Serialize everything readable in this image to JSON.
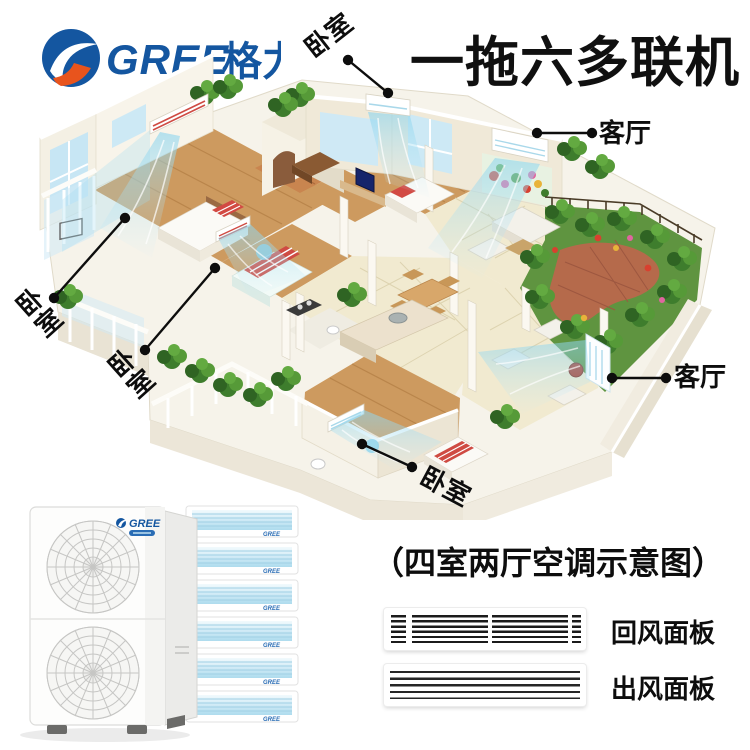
{
  "header": {
    "logo": {
      "text_en": "GREE",
      "text_cn": "格力"
    },
    "title": "一拖六多联机"
  },
  "diagram": {
    "callouts": [
      {
        "id": "bedroom-top",
        "label": "卧室"
      },
      {
        "id": "living-top-right",
        "label": "客厅"
      },
      {
        "id": "bedroom-left",
        "label": "卧室"
      },
      {
        "id": "bedroom-mid-left",
        "label": "卧室"
      },
      {
        "id": "bedroom-bottom",
        "label": "卧室"
      },
      {
        "id": "living-right",
        "label": "客厅"
      }
    ]
  },
  "products": {
    "outdoor_unit_brand": "GREE",
    "indoor_unit_count": "6",
    "caption": "（四室两厅空调示意图）",
    "panels": [
      {
        "label": "回风面板"
      },
      {
        "label": "出风面板"
      }
    ]
  },
  "colors": {
    "brand_blue": "#1456a0",
    "brand_orange": "#e8541d",
    "airflow_blue": "#9fdcf2",
    "label_black": "#0d0d0d"
  }
}
